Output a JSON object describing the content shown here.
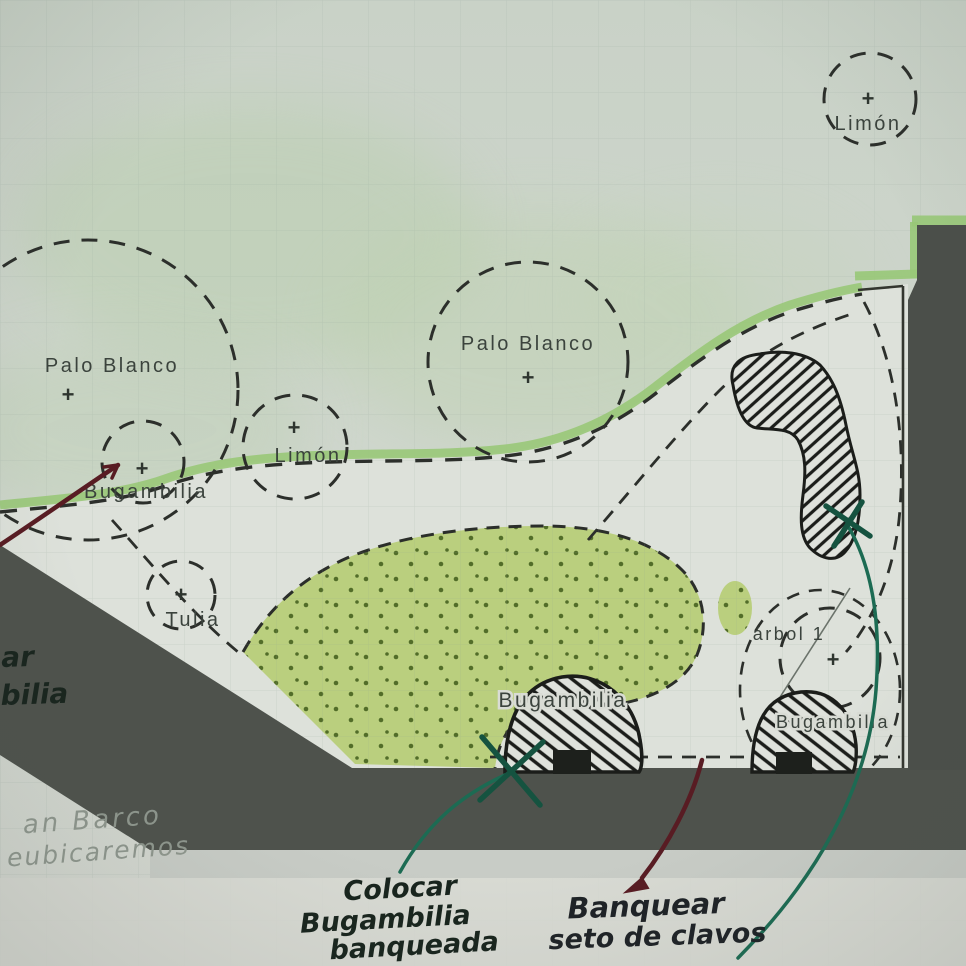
{
  "document": {
    "kind": "hand-drawn landscape planting plan (photo of sketch on gridded paper)"
  },
  "plan": {
    "plus_mark": "+",
    "trees": {
      "limon_top": "Limón",
      "palo_blanco_left": "Palo Blanco",
      "palo_blanco_center": "Palo Blanco",
      "limon_mid": "Limón",
      "bugambilia_left": "Bugambilia",
      "tulia": "Tulia",
      "arbol_1": "árbol 1",
      "bugambilia_center": "Bugambilia",
      "bugambilia_right": "Bugambilia"
    },
    "annotations": {
      "left_clipped_line1": "ar",
      "left_clipped_line2": "bilia",
      "pencil_line1": "an Barco",
      "pencil_line2": "eubicaremos",
      "colocar_line1": "Colocar",
      "colocar_line2": "Bugambilia",
      "colocar_line3": "banqueada",
      "banquear_line1": "Banquear",
      "banquear_line2": "seto de clavos"
    },
    "colors": {
      "paper": "#d3d8d0",
      "paper_green_wash": "#bccfb0",
      "plan_white": "#dde1da",
      "pavement_dark": "#4e524c",
      "pavement_light": "#c8ccc6",
      "hedge_green": "#99c878",
      "bed_green": "#bacf7e",
      "bed_dot_green": "#46621f",
      "ink": "#22251f",
      "label_gray": "#3b433d",
      "pencil_gray": "#8f978e",
      "maroon_arrow": "#581c23",
      "teal_arrow": "#1c6b53"
    }
  }
}
